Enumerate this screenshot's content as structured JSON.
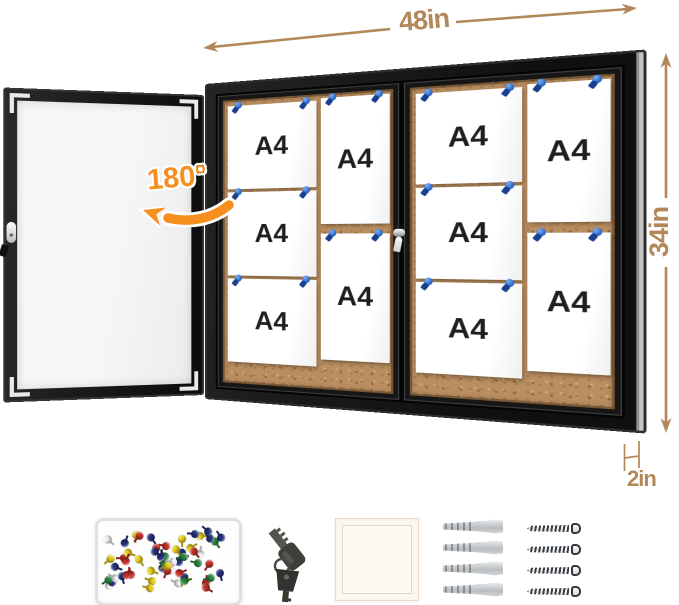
{
  "annotations": {
    "width_label": "48in",
    "height_label": "34in",
    "depth_label": "2in",
    "door_swing_label": "180°"
  },
  "board": {
    "paper_label": "A4",
    "panels": [
      {
        "name": "left-sliding-door",
        "columns": [
          {
            "orientation": "landscape",
            "count": 3
          },
          {
            "orientation": "portrait",
            "count": 2
          }
        ]
      },
      {
        "name": "right-sliding-door",
        "columns": [
          {
            "orientation": "landscape",
            "count": 3
          },
          {
            "orientation": "portrait",
            "count": 2
          }
        ]
      }
    ]
  },
  "colors": {
    "dimension_annotation": "#b3875a",
    "swing_annotation": "#f78f1e",
    "cork": "#b98e61",
    "frame_black": "#191919",
    "pin_blue": "#2e6fd0"
  },
  "accessories": {
    "pushpin_box": {
      "icon": "push-pins-box-icon",
      "pin_colors": [
        "#c8312b",
        "#26337f",
        "#2e8b45",
        "#e9cf1e",
        "#f2f2f2"
      ],
      "pin_count": 58
    },
    "keys": {
      "icon": "keys-icon",
      "count": 2
    },
    "paper_pad": {
      "icon": "paper-pad-icon"
    },
    "anchors": {
      "icon": "wall-anchors-icon",
      "count": 4
    },
    "screws": {
      "icon": "screws-icon",
      "count": 4
    }
  }
}
